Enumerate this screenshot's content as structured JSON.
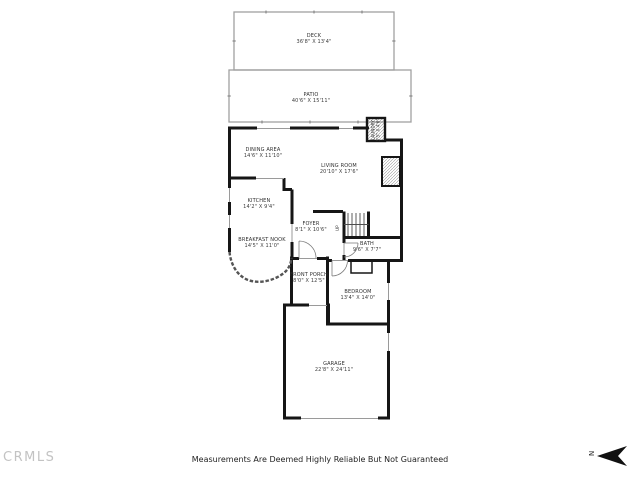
{
  "footer": {
    "watermark": "CRMLS",
    "disclaimer": "Measurements Are Deemed Highly Reliable But Not Guaranteed"
  },
  "compass": {
    "label": "N"
  },
  "colors": {
    "wall": "#161616",
    "thin_outline": "#a0a0a0",
    "label_text": "#3b3b3b",
    "watermark_gray": "#c3c3c3"
  },
  "rooms": {
    "deck": {
      "name": "DECK",
      "dims": "36'8\" X 13'4\""
    },
    "patio": {
      "name": "PATIO",
      "dims": "40'6\" X 15'11\""
    },
    "dining": {
      "name": "DINING AREA",
      "dims": "14'6\" X 11'10\""
    },
    "living": {
      "name": "LIVING ROOM",
      "dims": "20'10\" X 17'6\""
    },
    "kitchen": {
      "name": "KITCHEN",
      "dims": "14'2\" X 9'4\""
    },
    "foyer": {
      "name": "FOYER",
      "dims": "8'1\" X 10'6\""
    },
    "nook": {
      "name": "BREAKFAST NOOK",
      "dims": "14'5\" X 11'0\""
    },
    "bath": {
      "name": "BATH",
      "dims": "9'6\" X 7'7\""
    },
    "porch": {
      "name": "FRONT PORCH",
      "dims": "8'0\" X 12'5\""
    },
    "bedroom": {
      "name": "BEDROOM",
      "dims": "13'4\" X 14'0\""
    },
    "garage": {
      "name": "GARAGE",
      "dims": "22'8\" X 24'11\""
    },
    "laundry": {
      "name": "LAUNDRY",
      "dims": "3'5\" X 4'6\""
    },
    "stairs": {
      "name": "UP"
    }
  }
}
